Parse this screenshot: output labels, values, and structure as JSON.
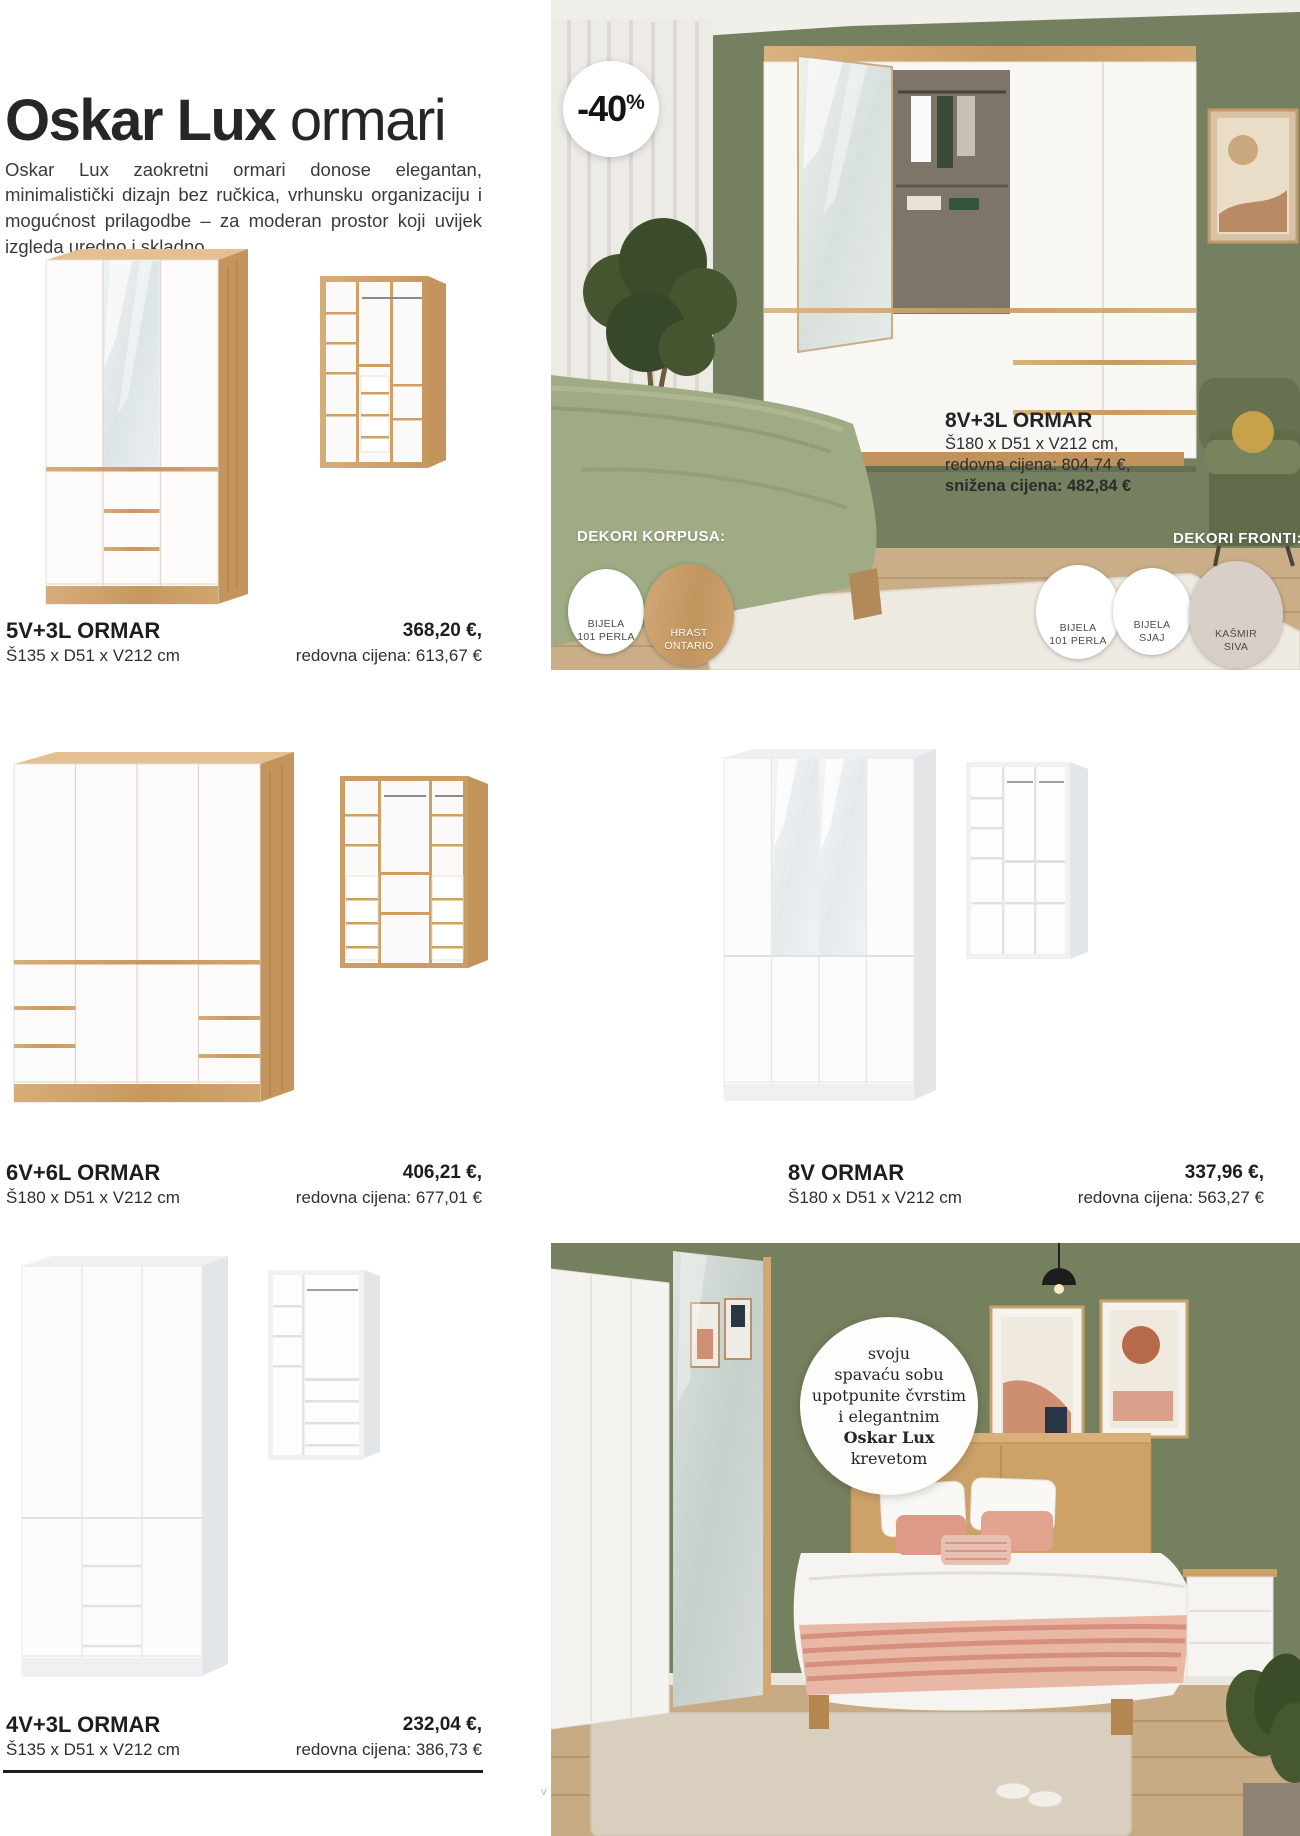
{
  "intro": {
    "title_bold": "Oskar Lux",
    "title_light": "ormari",
    "description": "Oskar Lux zaokretni ormari donose elegantan, minimalistički dizajn bez ručkica, vrhunsku organizaciju i mogućnost prilagodbe – za moderan prostor koji uvijek izgleda uredno i skladno."
  },
  "hero": {
    "badge_value": "-40",
    "badge_unit": "%",
    "name": "8V+3L ORMAR",
    "dimensions": "Š180 x D51 x V212 cm,",
    "regular_price": "redovna cijena: 804,74 €,",
    "sale_price": "snižena cijena: 482,84 €",
    "korpus_label": "DEKORI KORPUSA:",
    "fronti_label": "DEKORI FRONTI:",
    "korpus_swatches": [
      {
        "line1": "BIJELA",
        "line2": "101 PERLA",
        "color": "#ffffff"
      },
      {
        "line1": "HRAST",
        "line2": "ONTARIO",
        "color": "#c89a63"
      }
    ],
    "fronti_swatches": [
      {
        "line1": "BIJELA",
        "line2": "101 PERLA",
        "color": "#ffffff"
      },
      {
        "line1": "BIJELA",
        "line2": "SJAJ",
        "color": "#ffffff"
      },
      {
        "line1": "KAŠMIR",
        "line2": "SIVA",
        "color": "#d8d0c8"
      }
    ]
  },
  "products": [
    {
      "name": "5V+3L ORMAR",
      "dimensions": "Š135 x D51 x V212 cm",
      "sale_price": "368,20 €,",
      "regular_price": "redovna cijena: 613,67 €"
    },
    {
      "name": "6V+6L ORMAR",
      "dimensions": "Š180 x D51 x V212 cm",
      "sale_price": "406,21 €,",
      "regular_price": "redovna cijena: 677,01 €"
    },
    {
      "name": "8V ORMAR",
      "dimensions": "Š180 x D51 x V212 cm",
      "sale_price": "337,96 €,",
      "regular_price": "redovna cijena: 563,27 €"
    },
    {
      "name": "4V+3L ORMAR",
      "dimensions": "Š135 x D51 x V212 cm",
      "sale_price": "232,04 €,",
      "regular_price": "redovna cijena: 386,73 €"
    }
  ],
  "promo_circle": {
    "line1": "svoju",
    "line2": "spavaću sobu",
    "line3": "upotpunite čvrstim",
    "line4": "i elegantnim",
    "line5": "Oskar Lux",
    "line6": "krevetom"
  },
  "colors": {
    "wood_accent": "#c89a63",
    "wall_green": "#74805f",
    "kasmir_siva": "#d8d0c8",
    "duvet_sage": "#9fab84"
  },
  "watermark": "v"
}
